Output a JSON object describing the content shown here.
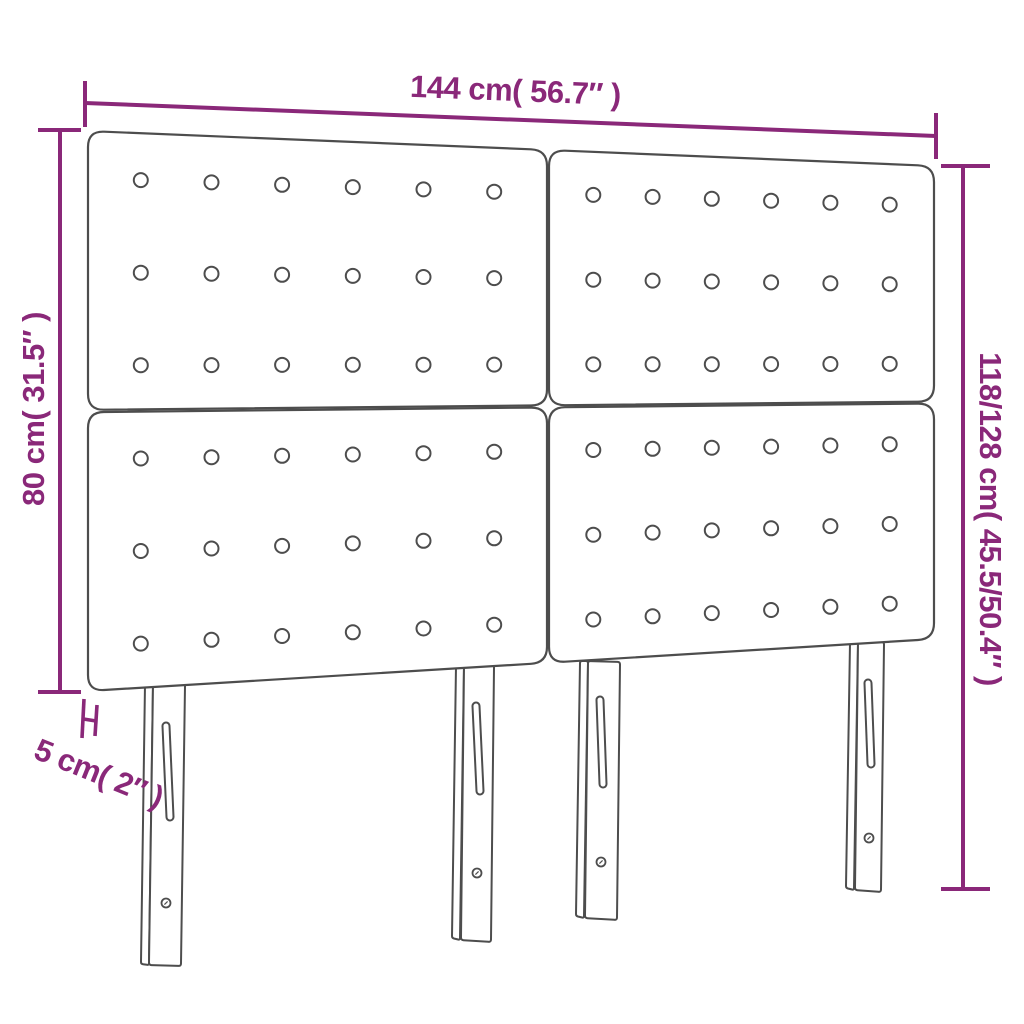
{
  "diagram": {
    "product": "headboard",
    "dimensions": {
      "width": "144 cm( 56.7″ )",
      "height_left": "80 cm( 31.5″ )",
      "height_right": "118/128 cm( 45.5/50.4″ )",
      "thickness": "5 cm( 2″ )"
    },
    "structure": {
      "panel_rows": 2,
      "panel_cols": 2,
      "button_cols_per_panel": 6,
      "button_rows_per_panel": 3,
      "leg_count": 4
    },
    "colors": {
      "accent": "#8a2879",
      "outline": "#4d4d4d",
      "fill": "#ffffff"
    }
  }
}
